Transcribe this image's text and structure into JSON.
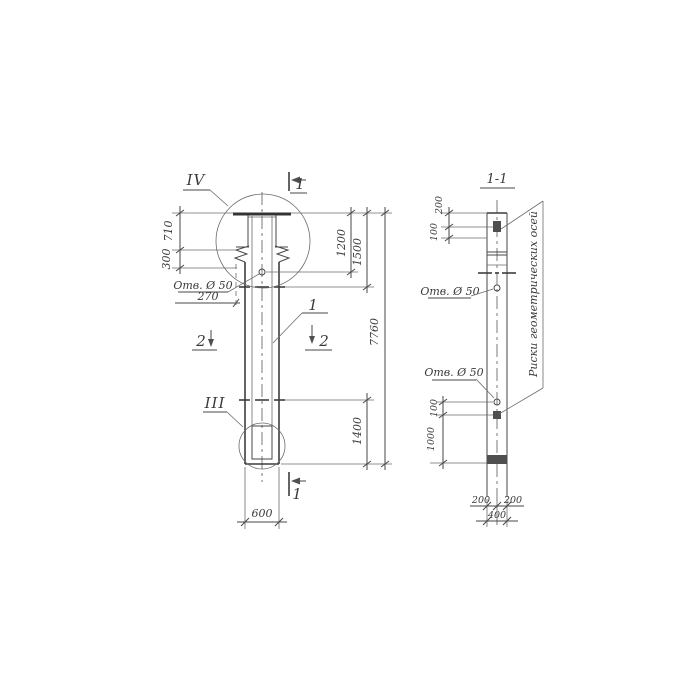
{
  "front_view": {
    "detail_labels": {
      "top": "IV",
      "bottom": "III"
    },
    "section_markers": {
      "top": "1",
      "bottom": "1",
      "left": "2",
      "right": "2"
    },
    "item_number": "1",
    "hole_label": "Отв. Ø 50",
    "dims": {
      "head_height": "710",
      "corbel_height": "300",
      "hole_offset": "270",
      "top_to_hole": "1200",
      "top_to_marks": "1500",
      "total_length": "7760",
      "marks_to_end": "1400",
      "width": "600"
    }
  },
  "section_view": {
    "title": "1-1",
    "hole_label_upper": "Отв. Ø 50",
    "hole_label_lower": "Отв. Ø 50",
    "axes_note": "Риски геометрических осей",
    "dims": {
      "top_to_hole": "200",
      "hole_to_plate": "100",
      "hole_to_mark": "100",
      "mark_to_end": "1000",
      "half_width_left": "200",
      "half_width_right": "200",
      "width": "400"
    }
  }
}
